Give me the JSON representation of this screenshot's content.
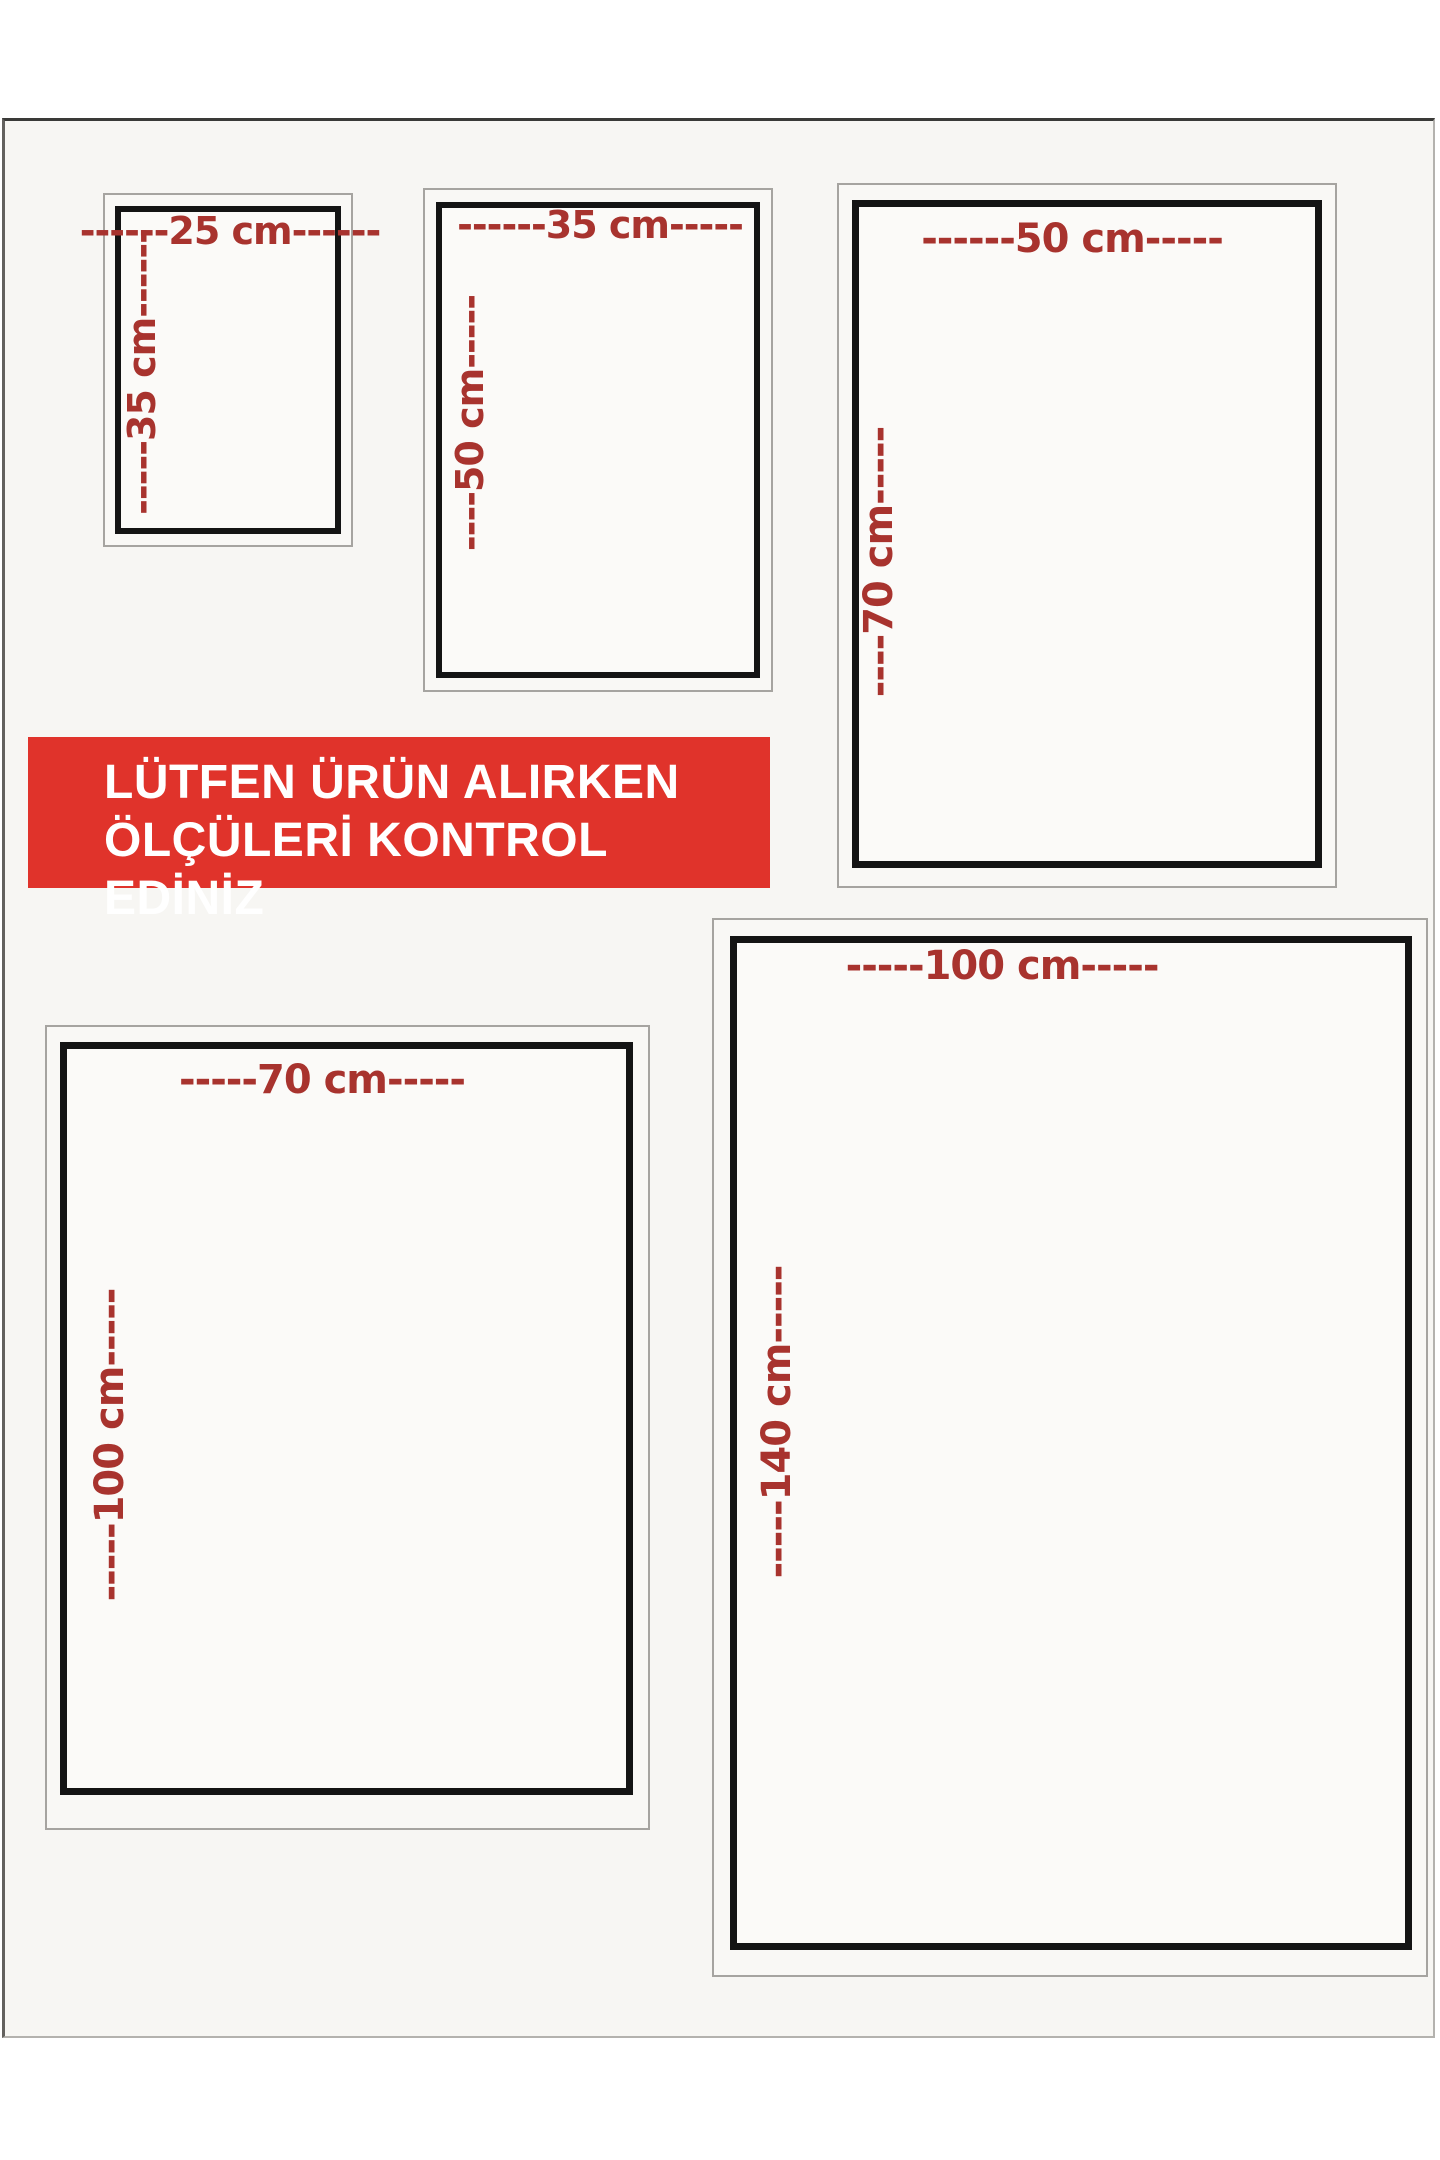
{
  "notice_banner": {
    "line1": "LÜTFEN ÜRÜN ALIRKEN",
    "line2": "ÖLÇÜLERİ KONTROL EDİNİZ",
    "background": "#e0332b",
    "text_color": "#ffffff"
  },
  "sizes": [
    {
      "name": "25x35",
      "width_cm": 25,
      "height_cm": 35,
      "width_label": "------25 cm------",
      "height_label": "-----35 cm------"
    },
    {
      "name": "35x50",
      "width_cm": 35,
      "height_cm": 50,
      "width_label": "------35 cm-----",
      "height_label": "----50 cm-----"
    },
    {
      "name": "50x70",
      "width_cm": 50,
      "height_cm": 70,
      "width_label": "------50 cm-----",
      "height_label": "----70 cm-----"
    },
    {
      "name": "70x100",
      "width_cm": 70,
      "height_cm": 100,
      "width_label": "-----70 cm-----",
      "height_label": "-----100 cm-----"
    },
    {
      "name": "100x140",
      "width_cm": 100,
      "height_cm": 140,
      "width_label": "-----100 cm-----",
      "height_label": "-----140 cm-----"
    }
  ],
  "colors": {
    "dimension_text": "#a8332e",
    "box_border": "#141414",
    "frame_border": "#a6a4a0",
    "page_sheet": "#f7f6f3"
  }
}
